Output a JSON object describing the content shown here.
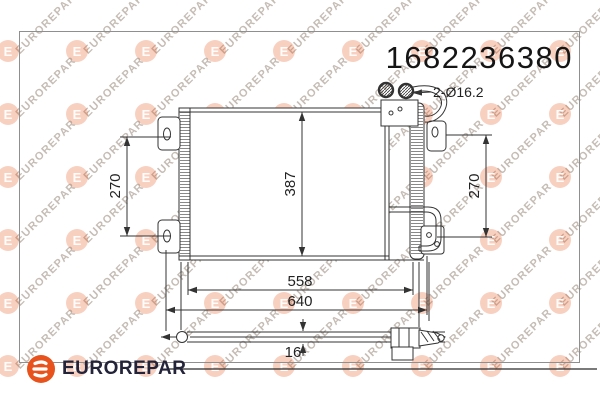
{
  "part_number": "1682236380",
  "brand": {
    "name": "EUROREPAR",
    "logo_color": "#e8521d",
    "text_color": "#23233a"
  },
  "watermark": {
    "text": "EUROREPAR",
    "logo_letter": "E"
  },
  "drawing": {
    "labels": {
      "ports": "2-Ø16.2",
      "dim_left_height": "270",
      "dim_core_height": "387",
      "dim_right_height": "270",
      "dim_inner_width": "558",
      "dim_outer_width": "640",
      "dim_depth": "16"
    }
  }
}
